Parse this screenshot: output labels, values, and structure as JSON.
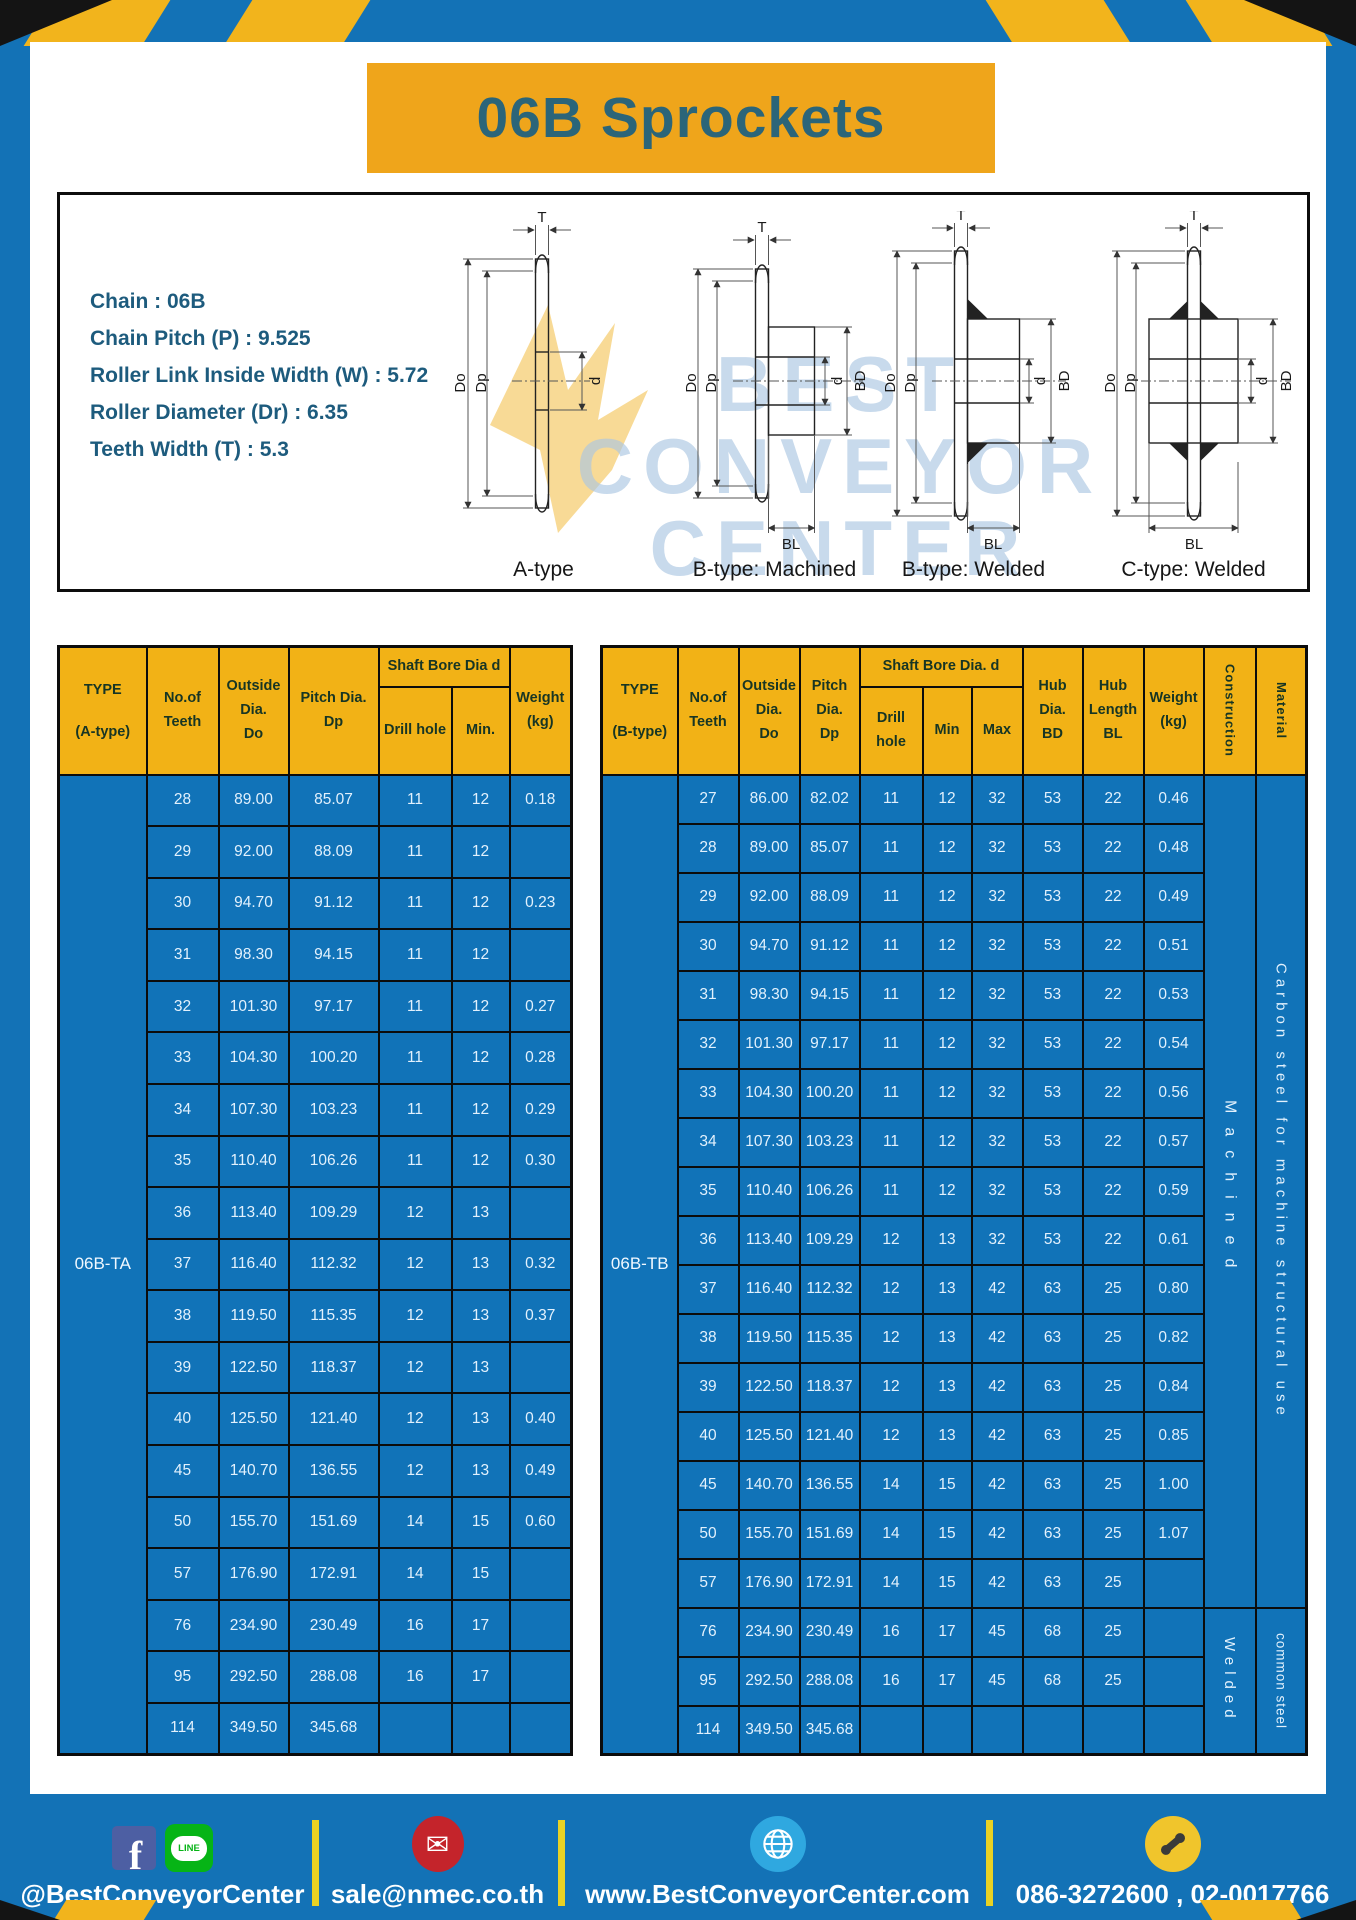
{
  "title": "06B Sprockets",
  "specs": [
    "Chain : 06B",
    "Chain Pitch (P) : 9.525",
    "Roller Link Inside Width (W) : 5.72",
    "Roller Diameter (Dr) : 6.35",
    "Teeth Width (T) : 5.3"
  ],
  "diagrams": {
    "watermark_lines": [
      "BEST",
      "CONVEYOR",
      "CENTER"
    ],
    "items": [
      {
        "label": "A-type"
      },
      {
        "label": "B-type: Machined"
      },
      {
        "label": "B-type: Welded"
      },
      {
        "label": "C-type: Welded"
      }
    ],
    "dims": {
      "t": "T",
      "do": "Do",
      "dp": "Dp",
      "d": "d",
      "bd": "BD",
      "bl": "BL"
    }
  },
  "table_a": {
    "headers": {
      "type": "TYPE\n(A-type)",
      "teeth": "No.of\nTeeth",
      "outside": "Outside\nDia.\nDo",
      "pitch": "Pitch Dia.\nDp",
      "shaft_bore": "Shaft Bore Dia d",
      "drill": "Drill hole",
      "min": "Min.",
      "weight": "Weight\n(kg)"
    },
    "type_value": "06B-TA",
    "rows": [
      [
        "28",
        "89.00",
        "85.07",
        "11",
        "12",
        "0.18"
      ],
      [
        "29",
        "92.00",
        "88.09",
        "11",
        "12",
        ""
      ],
      [
        "30",
        "94.70",
        "91.12",
        "11",
        "12",
        "0.23"
      ],
      [
        "31",
        "98.30",
        "94.15",
        "11",
        "12",
        ""
      ],
      [
        "32",
        "101.30",
        "97.17",
        "11",
        "12",
        "0.27"
      ],
      [
        "33",
        "104.30",
        "100.20",
        "11",
        "12",
        "0.28"
      ],
      [
        "34",
        "107.30",
        "103.23",
        "11",
        "12",
        "0.29"
      ],
      [
        "35",
        "110.40",
        "106.26",
        "11",
        "12",
        "0.30"
      ],
      [
        "36",
        "113.40",
        "109.29",
        "12",
        "13",
        ""
      ],
      [
        "37",
        "116.40",
        "112.32",
        "12",
        "13",
        "0.32"
      ],
      [
        "38",
        "119.50",
        "115.35",
        "12",
        "13",
        "0.37"
      ],
      [
        "39",
        "122.50",
        "118.37",
        "12",
        "13",
        ""
      ],
      [
        "40",
        "125.50",
        "121.40",
        "12",
        "13",
        "0.40"
      ],
      [
        "45",
        "140.70",
        "136.55",
        "12",
        "13",
        "0.49"
      ],
      [
        "50",
        "155.70",
        "151.69",
        "14",
        "15",
        "0.60"
      ],
      [
        "57",
        "176.90",
        "172.91",
        "14",
        "15",
        ""
      ],
      [
        "76",
        "234.90",
        "230.49",
        "16",
        "17",
        ""
      ],
      [
        "95",
        "292.50",
        "288.08",
        "16",
        "17",
        ""
      ],
      [
        "114",
        "349.50",
        "345.68",
        "",
        "",
        ""
      ]
    ]
  },
  "table_b": {
    "headers": {
      "type": "TYPE\n(B-type)",
      "teeth": "No.of\nTeeth",
      "outside": "Outside\nDia.\nDo",
      "pitch": "Pitch\nDia.\nDp",
      "shaft_bore": "Shaft Bore Dia. d",
      "drill": "Drill hole",
      "min": "Min",
      "max": "Max",
      "hub_dia": "Hub\nDia.\nBD",
      "hub_len": "Hub\nLength\nBL",
      "weight": "Weight\n(kg)",
      "construction": "Construction",
      "material": "Material"
    },
    "type_value": "06B-TB",
    "rows": [
      [
        "27",
        "86.00",
        "82.02",
        "11",
        "12",
        "32",
        "53",
        "22",
        "0.46"
      ],
      [
        "28",
        "89.00",
        "85.07",
        "11",
        "12",
        "32",
        "53",
        "22",
        "0.48"
      ],
      [
        "29",
        "92.00",
        "88.09",
        "11",
        "12",
        "32",
        "53",
        "22",
        "0.49"
      ],
      [
        "30",
        "94.70",
        "91.12",
        "11",
        "12",
        "32",
        "53",
        "22",
        "0.51"
      ],
      [
        "31",
        "98.30",
        "94.15",
        "11",
        "12",
        "32",
        "53",
        "22",
        "0.53"
      ],
      [
        "32",
        "101.30",
        "97.17",
        "11",
        "12",
        "32",
        "53",
        "22",
        "0.54"
      ],
      [
        "33",
        "104.30",
        "100.20",
        "11",
        "12",
        "32",
        "53",
        "22",
        "0.56"
      ],
      [
        "34",
        "107.30",
        "103.23",
        "11",
        "12",
        "32",
        "53",
        "22",
        "0.57"
      ],
      [
        "35",
        "110.40",
        "106.26",
        "11",
        "12",
        "32",
        "53",
        "22",
        "0.59"
      ],
      [
        "36",
        "113.40",
        "109.29",
        "12",
        "13",
        "32",
        "53",
        "22",
        "0.61"
      ],
      [
        "37",
        "116.40",
        "112.32",
        "12",
        "13",
        "42",
        "63",
        "25",
        "0.80"
      ],
      [
        "38",
        "119.50",
        "115.35",
        "12",
        "13",
        "42",
        "63",
        "25",
        "0.82"
      ],
      [
        "39",
        "122.50",
        "118.37",
        "12",
        "13",
        "42",
        "63",
        "25",
        "0.84"
      ],
      [
        "40",
        "125.50",
        "121.40",
        "12",
        "13",
        "42",
        "63",
        "25",
        "0.85"
      ],
      [
        "45",
        "140.70",
        "136.55",
        "14",
        "15",
        "42",
        "63",
        "25",
        "1.00"
      ],
      [
        "50",
        "155.70",
        "151.69",
        "14",
        "15",
        "42",
        "63",
        "25",
        "1.07"
      ],
      [
        "57",
        "176.90",
        "172.91",
        "14",
        "15",
        "42",
        "63",
        "25",
        ""
      ],
      [
        "76",
        "234.90",
        "230.49",
        "16",
        "17",
        "45",
        "68",
        "25",
        ""
      ],
      [
        "95",
        "292.50",
        "288.08",
        "16",
        "17",
        "45",
        "68",
        "25",
        ""
      ],
      [
        "114",
        "349.50",
        "345.68",
        "",
        "",
        "",
        "",
        "",
        ""
      ]
    ],
    "construction_groups": [
      {
        "label": "Machined",
        "rows": 17
      },
      {
        "label": "Welded",
        "rows": 3
      }
    ],
    "material_groups": [
      {
        "label": "Carbon steel for machine structural use",
        "rows": 17
      },
      {
        "label": "common steel",
        "rows": 3
      }
    ]
  },
  "footer": {
    "line_badge": "LINE",
    "items": [
      {
        "icon": "facebook-line-icons",
        "text": "@BestConveyorCenter"
      },
      {
        "icon": "email-icon",
        "text": "sale@nmec.co.th"
      },
      {
        "icon": "globe-icon",
        "text": "www.BestConveyorCenter.com"
      },
      {
        "icon": "phone-icon",
        "text": "086-3272600 , 02-0017766"
      }
    ]
  },
  "colors": {
    "brand_blue": "#1372b6",
    "brand_yellow": "#f2b41c",
    "banner_yellow": "#efa51b",
    "table_header_yellow": "#f2b216",
    "table_cell_blue": "#1173b8",
    "title_text": "#2b6579",
    "spec_text": "#1d5b7d",
    "separator_yellow": "#e9d224"
  }
}
